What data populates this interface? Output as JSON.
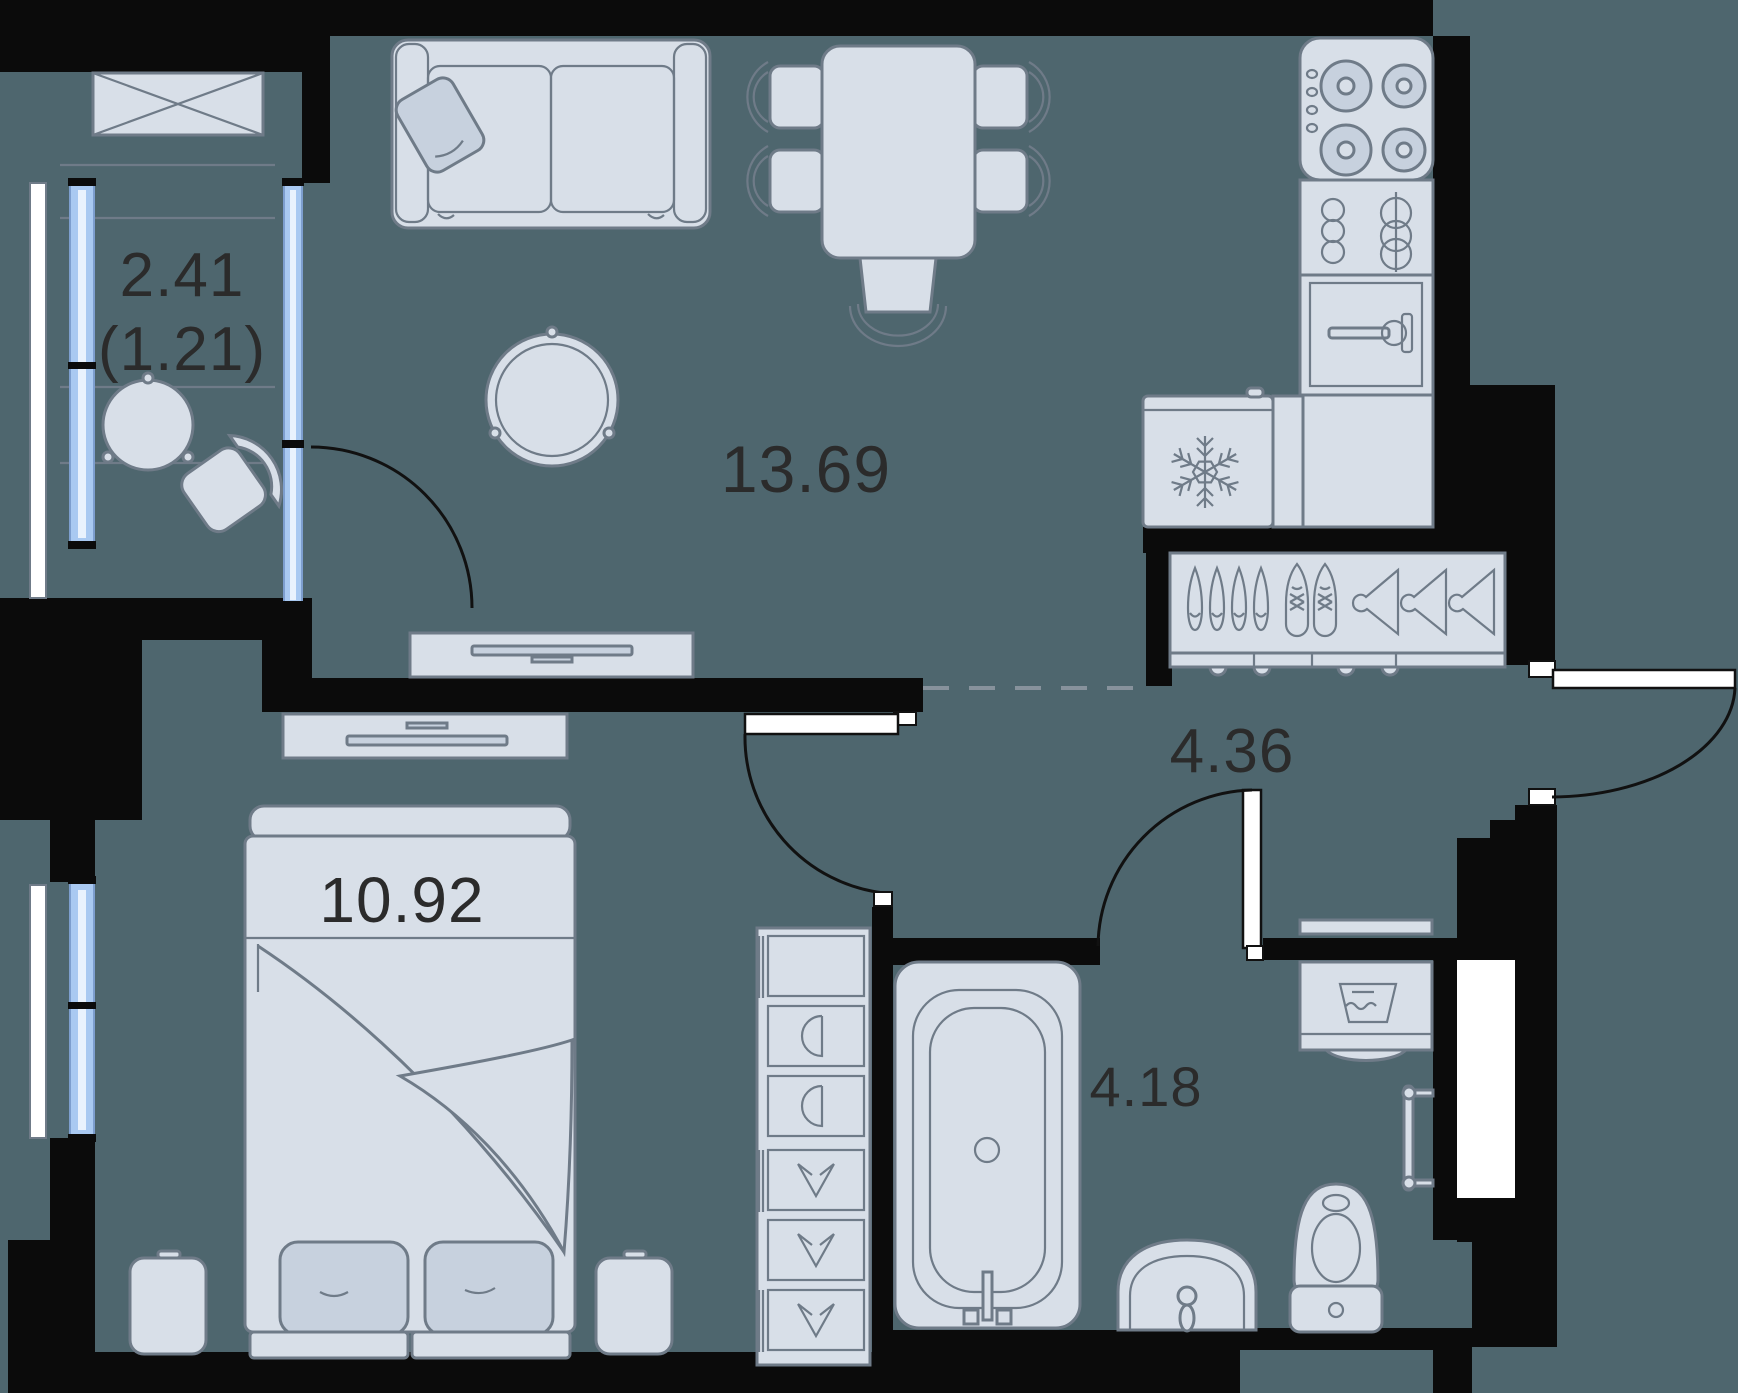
{
  "rooms": {
    "balcony": {
      "area": "2.41",
      "area_secondary": "(1.21)"
    },
    "living_room": {
      "area": "13.69"
    },
    "hallway": {
      "area": "4.36"
    },
    "bedroom": {
      "area": "10.92"
    },
    "bathroom": {
      "area": "4.18"
    }
  },
  "palette": {
    "floor": "#4e666e",
    "wall": "#0b0b0b",
    "furniture_fill": "#d8dfe8",
    "furniture_fill_dark": "#c7d1de",
    "outline": "#6f7b88",
    "white": "#ffffff",
    "glass": "#a9c9f1",
    "glass_frame": "#7d9ece",
    "dashed_line": "#87929c",
    "door_line": "#111111",
    "text": "#2b2b2b"
  }
}
